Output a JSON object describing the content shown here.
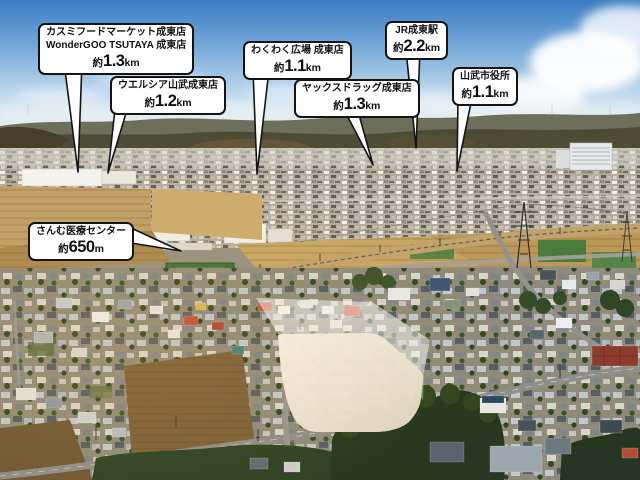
{
  "callouts": [
    {
      "name_lines": [
        "カスミフードマーケット成東店",
        "WonderGOO TSUTAYA 成東店"
      ],
      "distance": {
        "prefix": "約",
        "value": "1.3",
        "unit": "km"
      }
    },
    {
      "name_lines": [
        "ウエルシア山武成東店"
      ],
      "distance": {
        "prefix": "約",
        "value": "1.2",
        "unit": "km"
      }
    },
    {
      "name_lines": [
        "わくわく広場 成東店"
      ],
      "distance": {
        "prefix": "約",
        "value": "1.1",
        "unit": "km"
      }
    },
    {
      "name_lines": [
        "ヤックスドラッグ成東店"
      ],
      "distance": {
        "prefix": "約",
        "value": "1.3",
        "unit": "km"
      }
    },
    {
      "name_lines": [
        "JR成東駅"
      ],
      "distance": {
        "prefix": "約",
        "value": "2.2",
        "unit": "km"
      }
    },
    {
      "name_lines": [
        "山武市役所"
      ],
      "distance": {
        "prefix": "約",
        "value": "1.1",
        "unit": "km"
      }
    },
    {
      "name_lines": [
        "さんむ医療センター"
      ],
      "distance": {
        "prefix": "約",
        "value": "650",
        "unit": "m"
      }
    }
  ],
  "scene": {
    "regions": [
      "sky",
      "clouds",
      "distant-hills",
      "town-band",
      "farm-fields",
      "railway",
      "residential-area",
      "forest",
      "highlighted-site"
    ]
  },
  "colors": {
    "sky_top": "#3b7dc4",
    "callout_bg": "#ffffff",
    "callout_border": "#141414",
    "site_highlight": "#f0e9db",
    "field_tan": "#c7a665",
    "forest_green": "#26381f"
  }
}
